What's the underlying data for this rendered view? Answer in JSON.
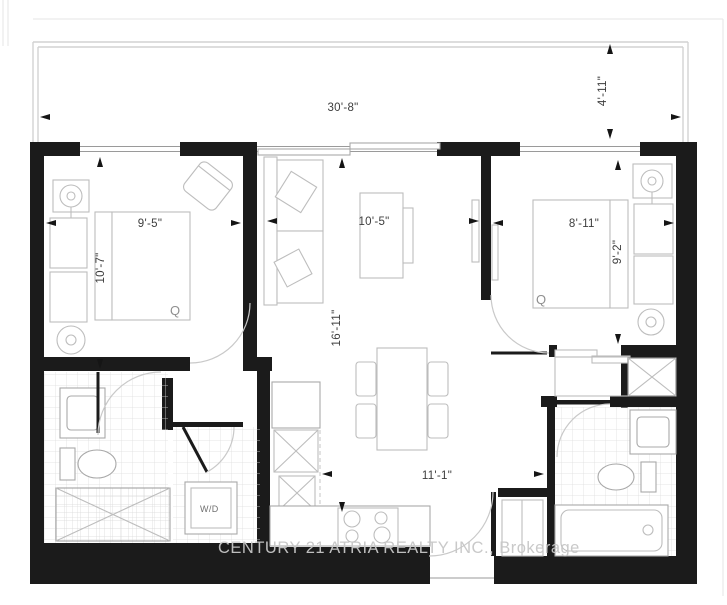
{
  "watermark": {
    "text": "CENTURY 21 ATRIA REALTY INC., Brokerage"
  },
  "dimensions": {
    "balcony_width": "30'-8\"",
    "balcony_depth": "4'-11\"",
    "bedroom1_width": "9'-5\"",
    "bedroom1_height": "10'-7\"",
    "living_width": "10'-5\"",
    "living_height": "16'-11\"",
    "bedroom2_width": "8'-11\"",
    "bedroom2_height": "9'-2\"",
    "hall_width": "11'-1\""
  },
  "labels": {
    "bed1": "Q",
    "bed2": "Q",
    "laundry": "W/D"
  }
}
